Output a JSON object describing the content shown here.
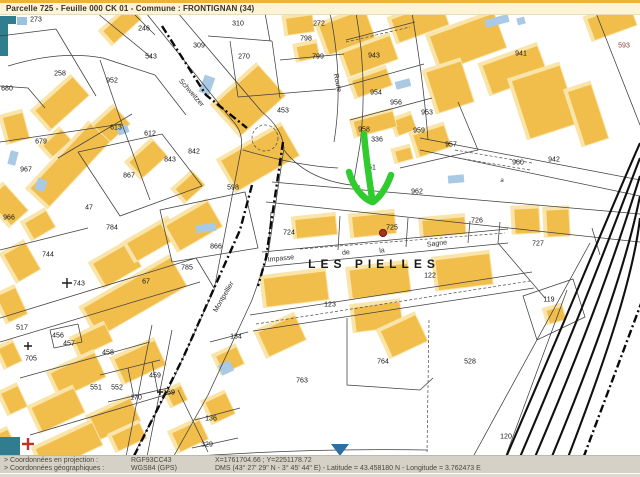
{
  "title_bar": {
    "text": "Parcelle 725 - Feuille 000 CK 01 - Commune : FRONTIGNAN (34)"
  },
  "map": {
    "selected_parcel": "725",
    "place_labels": [
      {
        "t": "LES PIELLES",
        "x": 374,
        "y": 264
      }
    ],
    "street_labels": [
      {
        "t": "Schweitzer",
        "x": 191,
        "y": 93,
        "r": 49
      },
      {
        "t": "Route",
        "x": 337,
        "y": 83,
        "r": 78
      },
      {
        "t": "Montpellier",
        "x": 224,
        "y": 297,
        "r": -60
      },
      {
        "t": "Impasse",
        "x": 281,
        "y": 259,
        "r": -6
      },
      {
        "t": "de",
        "x": 346,
        "y": 253,
        "r": -6
      },
      {
        "t": "la",
        "x": 382,
        "y": 251,
        "r": -6
      },
      {
        "t": "Sagne",
        "x": 437,
        "y": 244,
        "r": -7
      }
    ],
    "section_labels": [
      {
        "t": "a",
        "x": 502,
        "y": 181
      }
    ],
    "parcel_labels": [
      {
        "t": "273",
        "x": 36,
        "y": 20
      },
      {
        "t": "246",
        "x": 144,
        "y": 29
      },
      {
        "t": "543",
        "x": 151,
        "y": 57
      },
      {
        "t": "258",
        "x": 60,
        "y": 74
      },
      {
        "t": "952",
        "x": 112,
        "y": 81
      },
      {
        "t": "680",
        "x": 7,
        "y": 89
      },
      {
        "t": "310",
        "x": 238,
        "y": 24
      },
      {
        "t": "309",
        "x": 199,
        "y": 46
      },
      {
        "t": "270",
        "x": 244,
        "y": 57
      },
      {
        "t": "272",
        "x": 319,
        "y": 24
      },
      {
        "t": "798",
        "x": 306,
        "y": 39
      },
      {
        "t": "799",
        "x": 318,
        "y": 57
      },
      {
        "t": "453",
        "x": 283,
        "y": 111
      },
      {
        "t": "679",
        "x": 41,
        "y": 142
      },
      {
        "t": "613",
        "x": 116,
        "y": 128
      },
      {
        "t": "612",
        "x": 150,
        "y": 134
      },
      {
        "t": "842",
        "x": 194,
        "y": 152
      },
      {
        "t": "843",
        "x": 170,
        "y": 160
      },
      {
        "t": "867",
        "x": 129,
        "y": 176
      },
      {
        "t": "967",
        "x": 26,
        "y": 170
      },
      {
        "t": "966",
        "x": 9,
        "y": 218
      },
      {
        "t": "47",
        "x": 89,
        "y": 208
      },
      {
        "t": "784",
        "x": 112,
        "y": 228
      },
      {
        "t": "598",
        "x": 233,
        "y": 188
      },
      {
        "t": "866",
        "x": 216,
        "y": 247
      },
      {
        "t": "785",
        "x": 187,
        "y": 268
      },
      {
        "t": "744",
        "x": 48,
        "y": 255
      },
      {
        "t": "743",
        "x": 79,
        "y": 284
      },
      {
        "t": "67",
        "x": 146,
        "y": 282
      },
      {
        "t": "943",
        "x": 374,
        "y": 56
      },
      {
        "t": "941",
        "x": 521,
        "y": 54
      },
      {
        "t": "593",
        "x": 624,
        "y": 46,
        "c": "#8B3A2A"
      },
      {
        "t": "954",
        "x": 376,
        "y": 93
      },
      {
        "t": "956",
        "x": 396,
        "y": 103
      },
      {
        "t": "953",
        "x": 427,
        "y": 113
      },
      {
        "t": "958",
        "x": 364,
        "y": 130
      },
      {
        "t": "959",
        "x": 419,
        "y": 131
      },
      {
        "t": "957",
        "x": 451,
        "y": 145
      },
      {
        "t": "336",
        "x": 377,
        "y": 140
      },
      {
        "t": "951",
        "x": 370,
        "y": 168
      },
      {
        "t": "962",
        "x": 417,
        "y": 192
      },
      {
        "t": "960",
        "x": 518,
        "y": 163
      },
      {
        "t": "942",
        "x": 554,
        "y": 160
      },
      {
        "t": "724",
        "x": 289,
        "y": 233
      },
      {
        "t": "725",
        "x": 392,
        "y": 228
      },
      {
        "t": "726",
        "x": 477,
        "y": 221
      },
      {
        "t": "727",
        "x": 538,
        "y": 244
      },
      {
        "t": "122",
        "x": 430,
        "y": 276
      },
      {
        "t": "123",
        "x": 330,
        "y": 305
      },
      {
        "t": "763",
        "x": 302,
        "y": 381
      },
      {
        "t": "764",
        "x": 383,
        "y": 362
      },
      {
        "t": "528",
        "x": 470,
        "y": 362
      },
      {
        "t": "119",
        "x": 549,
        "y": 300
      },
      {
        "t": "120",
        "x": 506,
        "y": 437
      },
      {
        "t": "517",
        "x": 22,
        "y": 328
      },
      {
        "t": "705",
        "x": 31,
        "y": 359
      },
      {
        "t": "456",
        "x": 58,
        "y": 336
      },
      {
        "t": "457",
        "x": 69,
        "y": 344
      },
      {
        "t": "458",
        "x": 108,
        "y": 353
      },
      {
        "t": "459",
        "x": 155,
        "y": 376
      },
      {
        "t": "551",
        "x": 96,
        "y": 388
      },
      {
        "t": "552",
        "x": 117,
        "y": 388
      },
      {
        "t": "170",
        "x": 136,
        "y": 398
      },
      {
        "t": "169",
        "x": 169,
        "y": 393
      },
      {
        "t": "134",
        "x": 236,
        "y": 337
      },
      {
        "t": "136",
        "x": 211,
        "y": 419
      },
      {
        "t": "329",
        "x": 207,
        "y": 445
      }
    ]
  },
  "status_bar": {
    "rows": [
      {
        "label": "> Coordonnées en projection :",
        "system": "RGF93CC43",
        "value": "X=1761704.66 ; Y=2251178.72"
      },
      {
        "label": "> Coordonnées géographiques :",
        "system": "WGS84 (GPS)",
        "value": "DMS (43° 27' 29\" N - 3° 45' 44\" E) - Latitude = 43.458180 N - Longitude = 3.762473 E"
      }
    ]
  }
}
